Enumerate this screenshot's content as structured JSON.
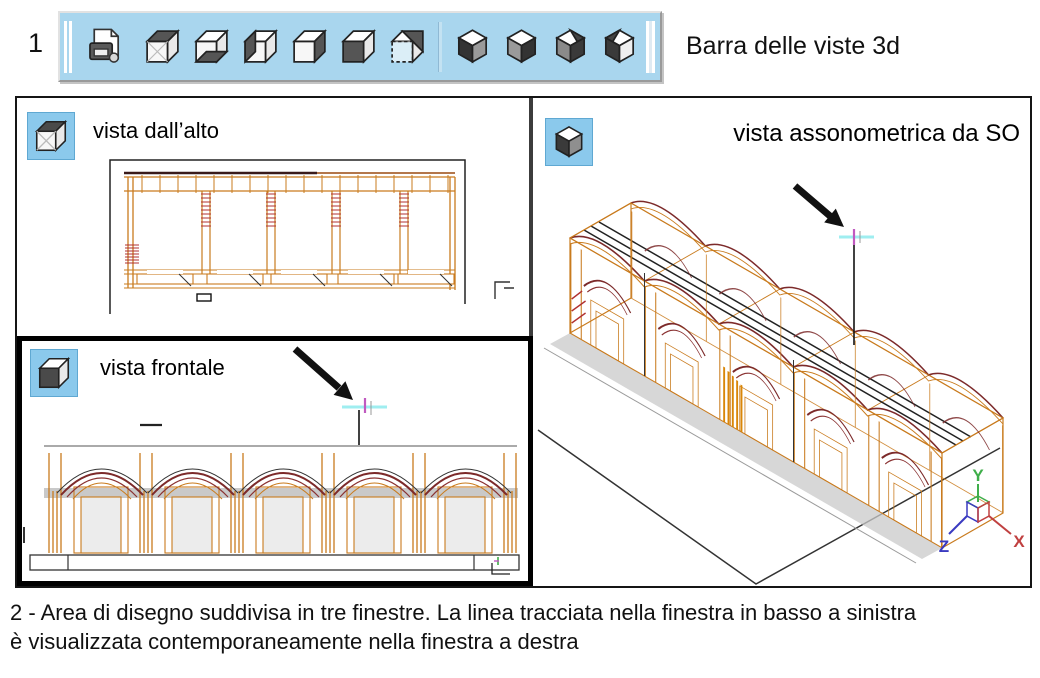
{
  "figure1": {
    "number": "1",
    "toolbar_caption": "Barra delle viste 3d"
  },
  "toolbar": {
    "icons": [
      "named-views-icon",
      "top-view-cube-icon",
      "bottom-view-cube-icon",
      "left-view-cube-icon",
      "right-view-cube-icon",
      "front-view-cube-icon",
      "back-view-cube-icon",
      "sw-isometric-cube-icon",
      "se-isometric-cube-icon",
      "ne-isometric-cube-icon",
      "nw-isometric-cube-icon"
    ]
  },
  "viewports": {
    "top": {
      "label": "vista dall’alto",
      "icon": "top-view-cube-icon"
    },
    "front": {
      "label": "vista frontale",
      "icon": "front-view-cube-icon"
    },
    "iso": {
      "label": "vista assonometrica da SO",
      "icon": "sw-isometric-cube-icon"
    }
  },
  "ucs": {
    "x": "X",
    "y": "Y",
    "z": "Z"
  },
  "figure2": {
    "caption_line1": "2 - Area di disegno suddivisa in tre finestre. La linea tracciata nella finestra in basso a sinistra",
    "caption_line2": "è visualizzata contemporaneamente nella finestra a destra"
  },
  "colors": {
    "toolbar_bg": "#a9d6ee",
    "icon_box_bg": "#8bc9ec",
    "cad_orange": "#c97b1e",
    "cad_bright_orange": "#d98608",
    "cad_maroon": "#7c2a2a",
    "cad_red": "#b03030",
    "shadow_gray": "#c9c9c9",
    "cursor_cyan": "#9feef0",
    "cursor_magenta": "#c05ac0",
    "axis_x_red": "#c04040",
    "axis_y_green": "#3fae4a",
    "axis_z_blue": "#3a3ac0"
  }
}
